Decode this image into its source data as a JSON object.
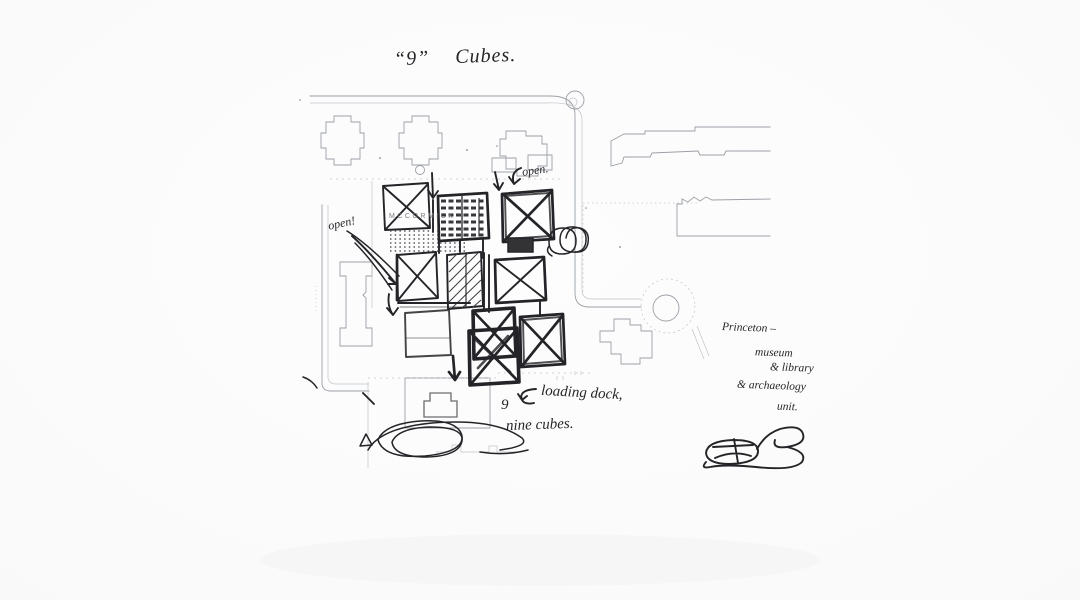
{
  "meta": {
    "description": "Hand-drawn architect concept sketch of nine cubes over a Princeton campus site plan",
    "background_color": "#fafafa",
    "ink_color": "#242428",
    "plan_line_color": "#9ba0a6",
    "cube_count": 9
  },
  "annotations": {
    "title_nine": "“9”",
    "title_cubes": "Cubes.",
    "open_note_top": "open.",
    "open_note_left": "open!",
    "building_label": "MCCORMICK",
    "loading_dock_note": "loading dock,",
    "nine_digit": "9",
    "nine_cubes_note": "nine cubes.",
    "princeton_note_lines": [
      "Princeton –",
      "museum",
      "& library",
      "& archaeology",
      "unit."
    ]
  },
  "icons": {
    "signature": "architect-monogram-signature",
    "arrow_top_left": "down-arrow",
    "arrow_top_mid": "down-arrow",
    "arrow_open_top": "curved-down-left-arrow",
    "arrow_open_left": "diagonal-strokes-arrow",
    "arrow_mid_left": "down-arrow",
    "arrow_bottom": "down-arrow",
    "arrow_loading_dock": "curved-left-arrow",
    "scribble_right": "spiral-circles-scribble",
    "scribble_bottom_left": "overlapping-ellipses-scribble",
    "plan_roundabout": "roundabout-circle",
    "plan_plaza": "circular-plaza"
  }
}
